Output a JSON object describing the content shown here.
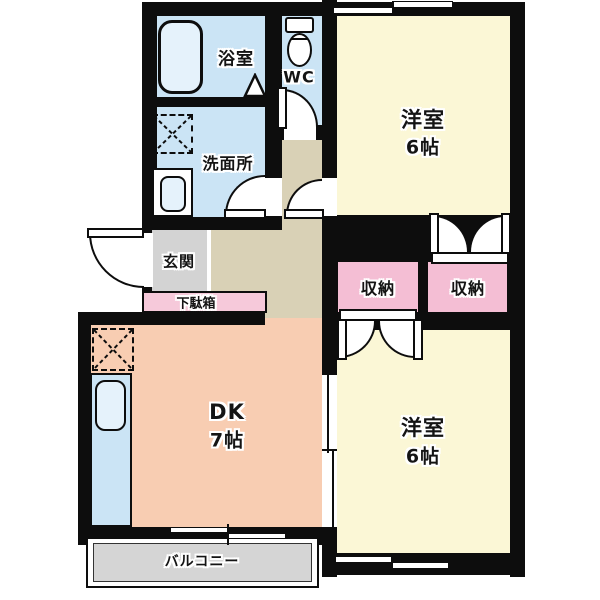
{
  "title": "2DK apartment floor plan",
  "rooms": {
    "bathroom": {
      "label": "浴室"
    },
    "toilet_room": {
      "label": "WC"
    },
    "washroom": {
      "label": "洗面所"
    },
    "entrance": {
      "label": "玄関"
    },
    "shoe_cabinet": {
      "label": "下駄箱"
    },
    "bedroom_upper": {
      "label": "洋室",
      "size": "6帖"
    },
    "bedroom_lower": {
      "label": "洋室",
      "size": "6帖"
    },
    "storage_left": {
      "label": "収納"
    },
    "storage_right": {
      "label": "収納"
    },
    "dining_kitchen": {
      "label": "DK",
      "size": "7帖"
    },
    "balcony": {
      "label": "バルコニー"
    }
  },
  "fixtures": [
    "bathtub",
    "toilet",
    "washing-machine-space",
    "washroom-sink",
    "kitchen-counter",
    "kitchen-sink",
    "refrigerator-space"
  ],
  "colors": {
    "wet_area": "#CBE4F5",
    "bedroom": "#FBF7D6",
    "dining_kitchen": "#F8CDB2",
    "hallway": "#D9D1B6",
    "entrance": "#D3D3D3",
    "storage_pink": "#F4BED4",
    "shoe_cabinet_pink": "#F6C9DA",
    "balcony_gray": "#D5D5D5",
    "fixture_blue": "#E5F2FB",
    "wall": "#0D0D0D"
  }
}
